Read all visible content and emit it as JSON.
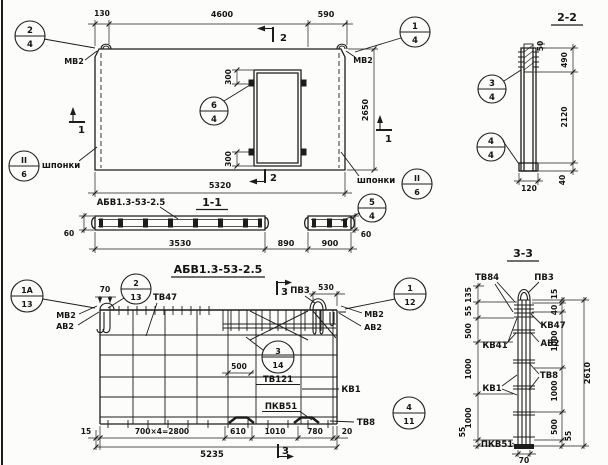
{
  "plan_view": {
    "callouts": {
      "c24": {
        "num": "2",
        "sheet": "4"
      },
      "c14": {
        "num": "1",
        "sheet": "4"
      },
      "c64": {
        "num": "6",
        "sheet": "4"
      },
      "key_left": {
        "num": "II",
        "sheet": "6"
      },
      "key_right": {
        "num": "II",
        "sheet": "6"
      }
    },
    "labels": {
      "mv2_left": "МВ2",
      "mv2_right": "МВ2",
      "keys_left": "шпонки",
      "keys_right": "шпонки"
    },
    "dims": {
      "offset_left": "130",
      "top_main": "4600",
      "top_right": "590",
      "height": "2650",
      "bottom": "5320",
      "opening_top": "300",
      "opening_bottom": "300"
    },
    "markers": {
      "s2_top": "2",
      "s2_bottom": "2",
      "s1_left": "1",
      "s1_right": "1"
    }
  },
  "section_1_1": {
    "title": "1-1",
    "panel_mark": "АБВ1.3-53-2.5",
    "callout_54": {
      "num": "5",
      "sheet": "4"
    },
    "dims": {
      "thick_left": "60",
      "thick_right": "60",
      "len_main": "3530",
      "len_opening": "890",
      "len_right": "900"
    }
  },
  "section_2_2": {
    "title": "2-2",
    "callout_34": {
      "num": "3",
      "sheet": "4"
    },
    "callout_44": {
      "num": "4",
      "sheet": "4"
    },
    "dims": {
      "top_offset": "50",
      "top": "490",
      "middle": "2120",
      "bottom": "40",
      "width": "120"
    }
  },
  "reinforcement_view": {
    "title": "АБВ1.3-53-2.5",
    "callouts": {
      "c1a13": {
        "num": "1А",
        "sheet": "13"
      },
      "c213": {
        "num": "2",
        "sheet": "13"
      },
      "c112": {
        "num": "1",
        "sheet": "12"
      },
      "c314": {
        "num": "3",
        "sheet": "14"
      },
      "c411": {
        "num": "4",
        "sheet": "11"
      }
    },
    "labels": {
      "mv2_left": "МВ2",
      "av2_left": "АВ2",
      "tv47": "ТВ47",
      "pv3": "ПВ3",
      "mv2_right": "МВ2",
      "av2_right": "АВ2",
      "tv121": "ТВ121",
      "kv1": "КВ1",
      "pkv51": "ПКВ51",
      "tv8": "ТВ8"
    },
    "dims": {
      "hook_spacing": "70",
      "loop_offset": "530",
      "mesh_step": "500",
      "left_margin": "15",
      "main_step": "700×4=2800",
      "d610": "610",
      "d1010": "1010",
      "d780": "780",
      "right_margin": "20",
      "total": "5235"
    },
    "markers": {
      "s3_top": "3",
      "s3_bottom": "3"
    }
  },
  "section_3_3": {
    "title": "3-3",
    "labels": {
      "tv84": "ТВ84",
      "pv3": "ПВ3",
      "kv47": "КВ47",
      "av2": "АВ2",
      "kv41": "КВ41",
      "kv1": "КВ1",
      "tv8": "ТВ8",
      "pkv51": "ПКВ51"
    },
    "dims_left": [
      "135",
      "55",
      "500",
      "1000",
      "1000",
      "55"
    ],
    "dims_right": [
      "15",
      "40",
      "1000",
      "1000",
      "500",
      "55"
    ],
    "dims": {
      "total": "2610",
      "width": "70"
    }
  }
}
